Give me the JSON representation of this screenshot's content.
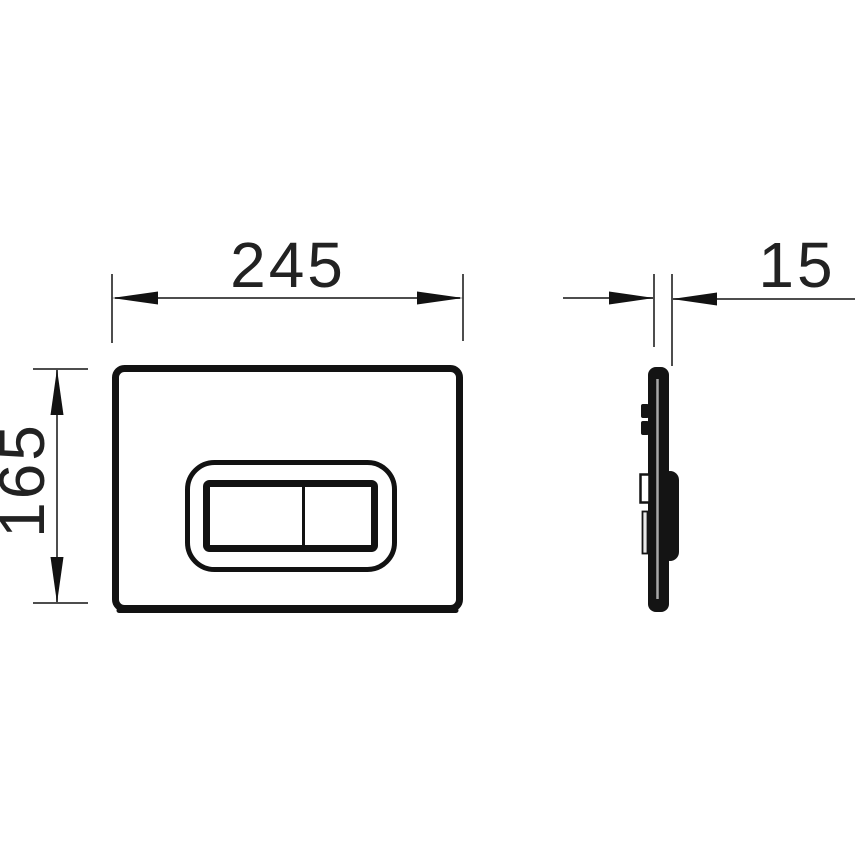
{
  "dimensions": {
    "width": "245",
    "height": "165",
    "depth": "15"
  },
  "colors": {
    "background": "#ffffff",
    "outline": "#121212",
    "thin_line": "#4d4d4d",
    "text": "#222222",
    "profile_fill": "#141414",
    "profile_inner_highlight": "#a8a8a8"
  }
}
